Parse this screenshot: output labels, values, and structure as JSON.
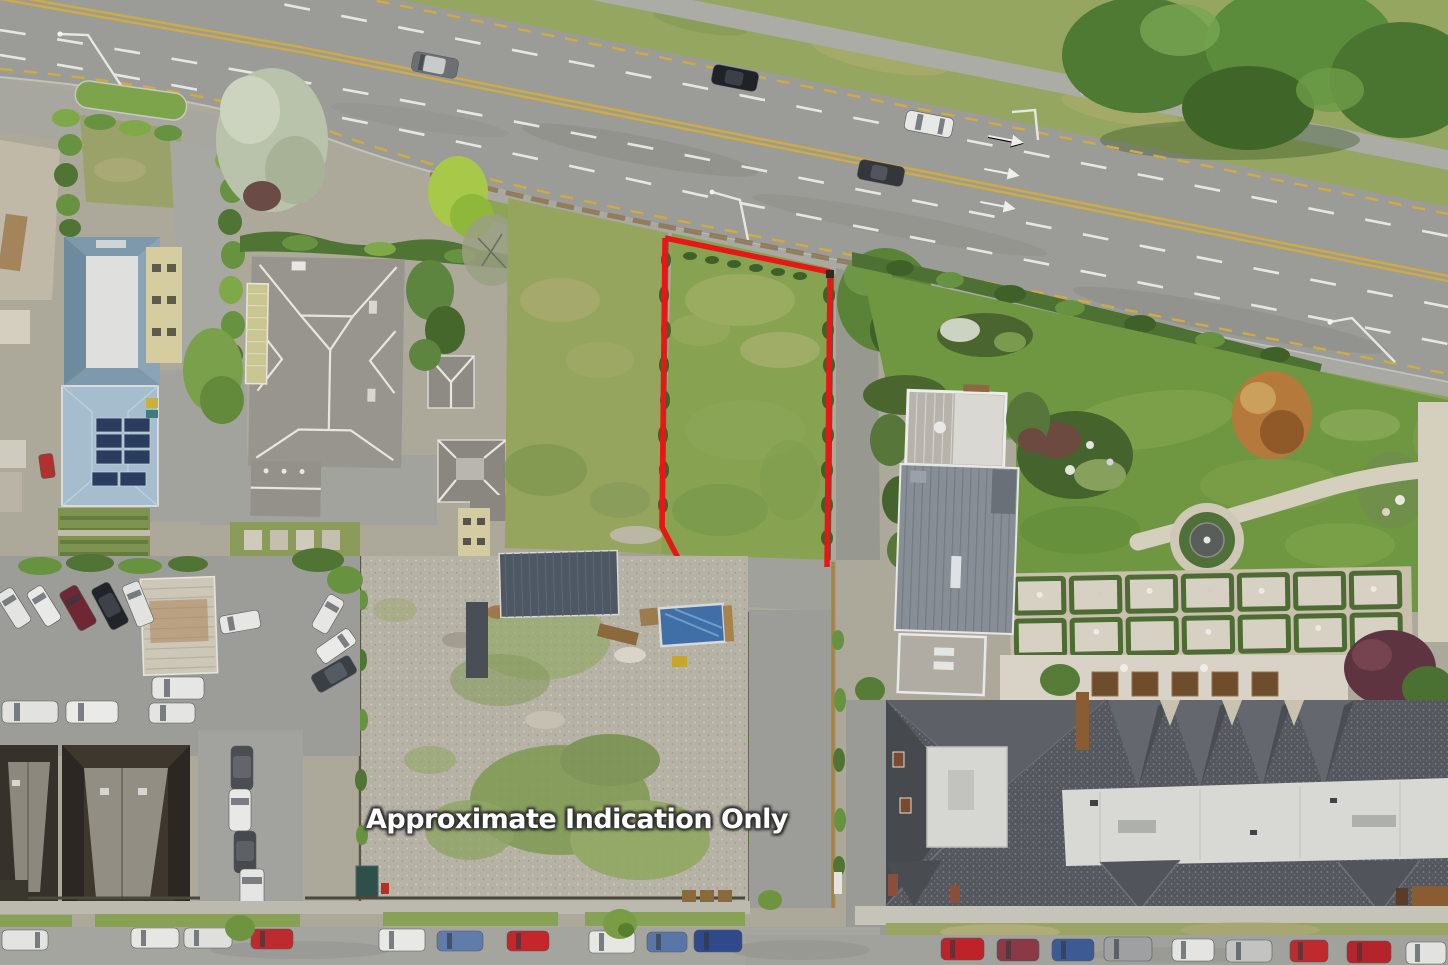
{
  "image": {
    "kind": "aerial-drone-photograph",
    "subject": "vacant residential land parcel outlined in red beside an arterial road",
    "orientation": "top-down"
  },
  "overlay": {
    "disclaimer": "Approximate Indication Only",
    "text_color": "#ffffff",
    "outline_color": "#2d2d2d"
  },
  "boundary": {
    "color": "#e81616",
    "stroke_width": 5,
    "shape": "open rectangle (no bottom edge)",
    "marks_label": "highlighted-section-boundary"
  },
  "road_markings": {
    "center_line_color": "#d2ae45",
    "edge_dash_color": "#cfab41",
    "lane_dash_color": "#efefea",
    "lane_arrow_icon": "straight-arrow-marking",
    "lane_arrow_count": 3,
    "bike_lane_icon": "bicycle-lane-marking",
    "moving_vehicle_count": 4
  },
  "scene_objects": {
    "vacant_lot": "grass section inside red boundary",
    "neighbouring_lot": "grass section left of boundary",
    "gravel_yard": "cleared construction yard with moss patches",
    "lap_pool_color": "#3f6fa6",
    "hotel_roof_colors": [
      "#54585e",
      "#d8d9d5"
    ],
    "modern_house_roof_color": "#878e95",
    "blue_roof_color": "#7e98ac",
    "solar_panel_color": "#2a3d5e",
    "fountain": "circular garden fountain",
    "parterre": "formal hedge parterre garden",
    "parked_vehicle_count_bottom_street": 19,
    "parked_vehicle_count_car_yard": 16
  },
  "palette": {
    "asphalt": "#9b9c97",
    "footpath": "#a8a9a2",
    "lawn": "#6f9741",
    "field_grass": "#87a351",
    "hedge": "#4f7434",
    "gravel": "#b6b2a6"
  }
}
